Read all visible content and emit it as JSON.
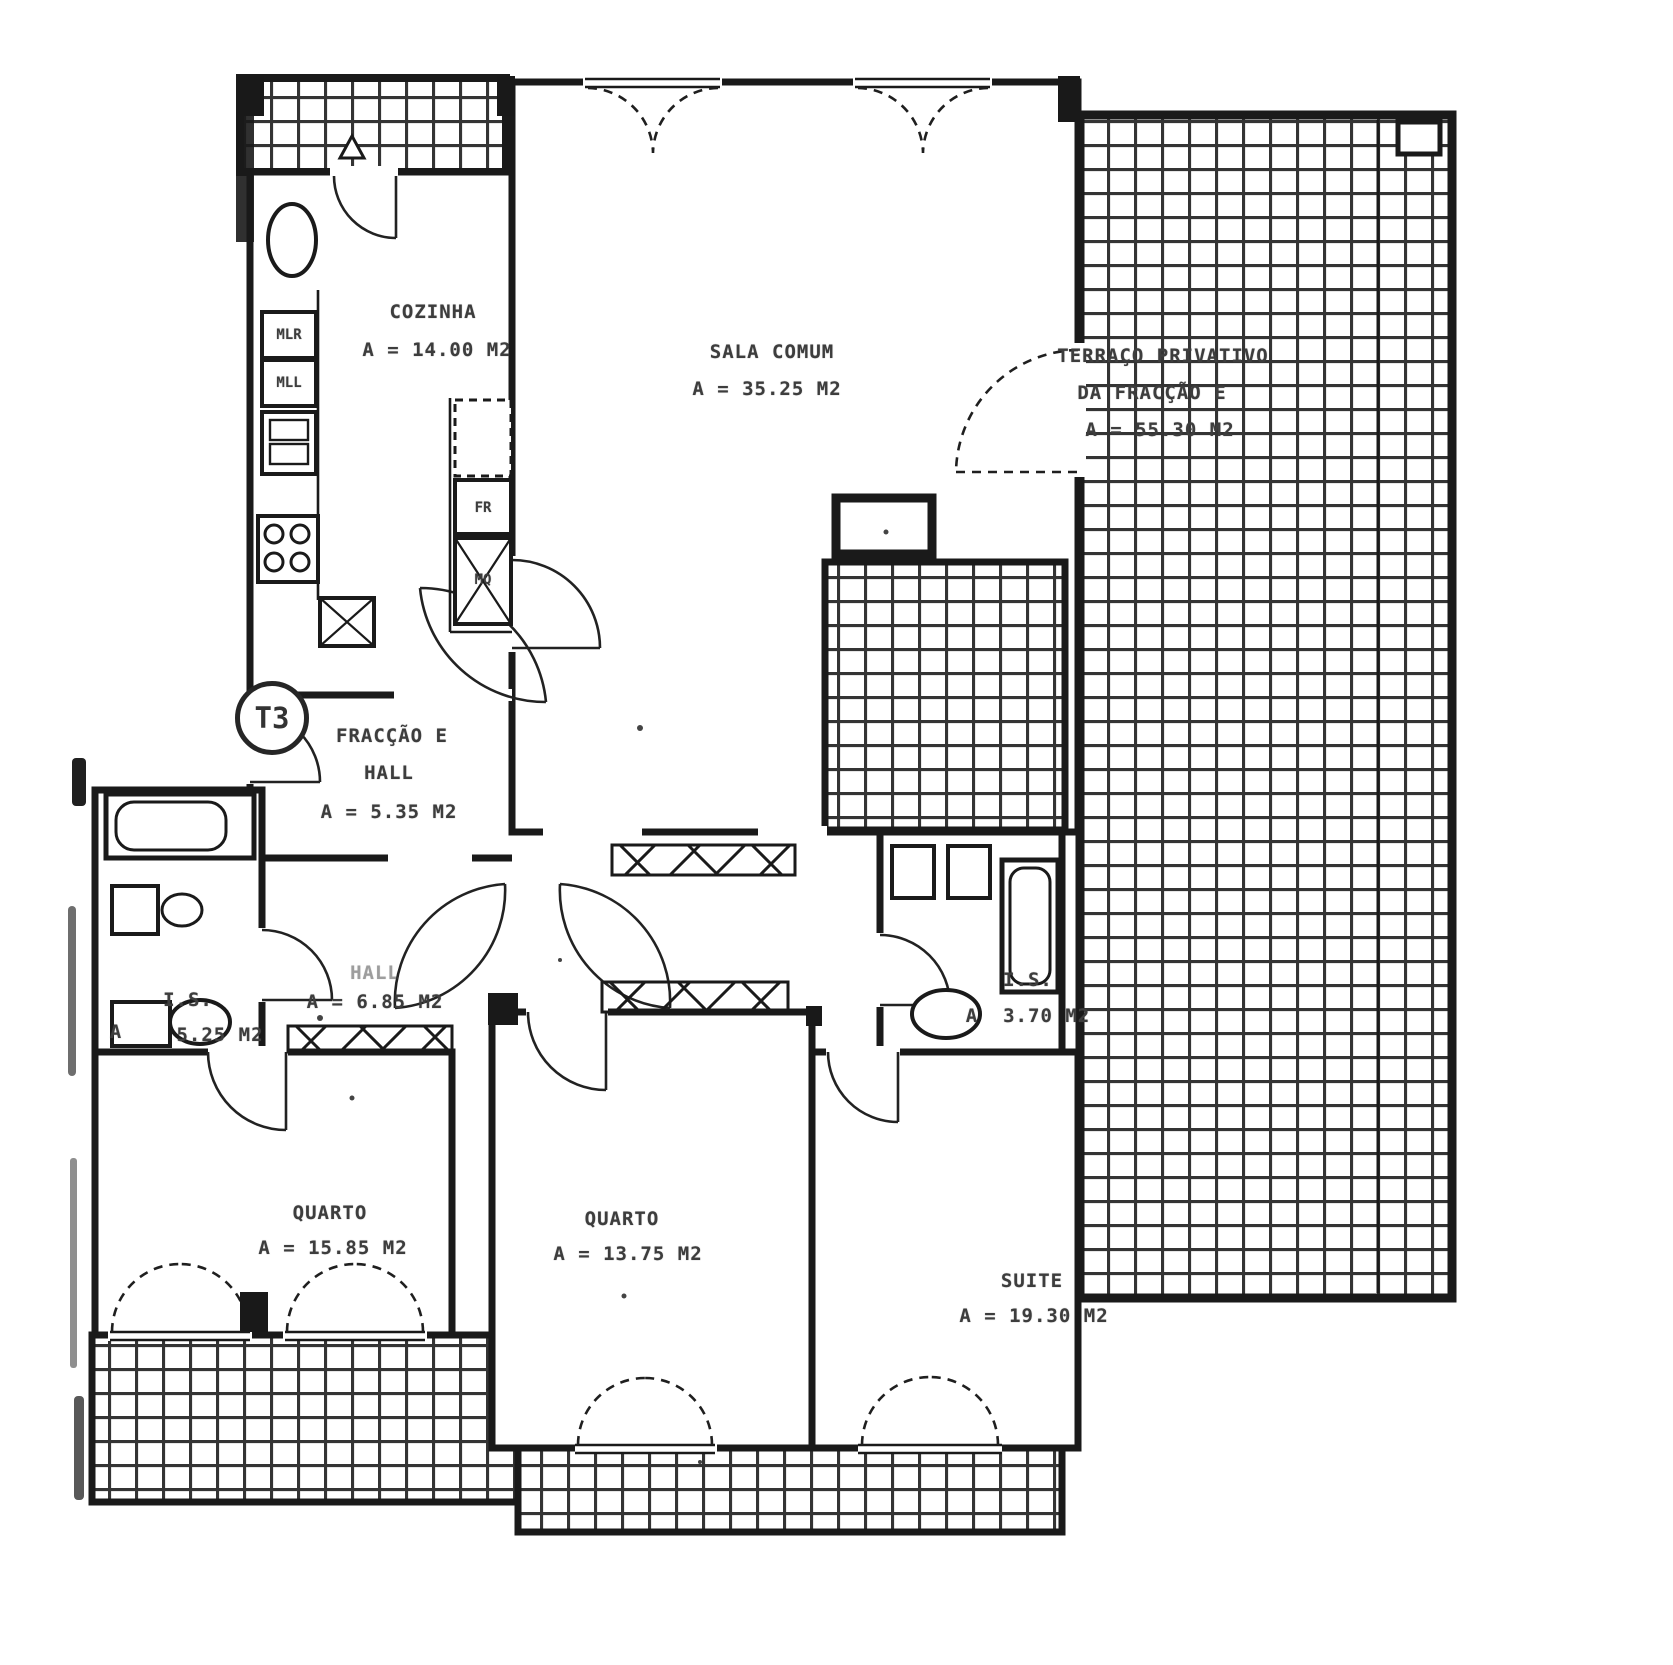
{
  "document": {
    "type": "Scanned architectural floor plan",
    "unit_type": "T3"
  },
  "badge": {
    "label": "T3"
  },
  "rooms": {
    "cozinha": {
      "name": "COZINHA",
      "area": "A = 14.00 M2"
    },
    "sala_comum": {
      "name": "SALA COMUM",
      "area": "A = 35.25 M2"
    },
    "terraco": {
      "name": "TERRAÇO PRIVATIVO",
      "name2": "DA FRACÇÃO E",
      "area": "A = 55.30 M2"
    },
    "fraccao": {
      "name": "FRACÇÃO E",
      "name2": "HALL",
      "area": "A = 5.35 M2"
    },
    "hall": {
      "name": "HALL",
      "area": "A = 6.85 M2"
    },
    "is_left": {
      "name": "I.S.",
      "prefix": "A",
      "area": "5.25 M2"
    },
    "is_right": {
      "name": "I.S.",
      "area": "A  3.70 M2"
    },
    "quarto_left": {
      "name": "QUARTO",
      "area": "A = 15.85 M2"
    },
    "quarto_middle": {
      "name": "QUARTO",
      "area": "A = 13.75 M2"
    },
    "suite": {
      "name": "SUITE",
      "area": "A = 19.30 M2"
    }
  },
  "appliances": {
    "mlr": "MLR",
    "mll": "MLL",
    "fr": "FR",
    "mq": "MQ"
  },
  "colors": {
    "wall": "#1a1a1a",
    "tile_line": "#343434",
    "text": "#3d3d3d",
    "paper": "#ffffff"
  }
}
